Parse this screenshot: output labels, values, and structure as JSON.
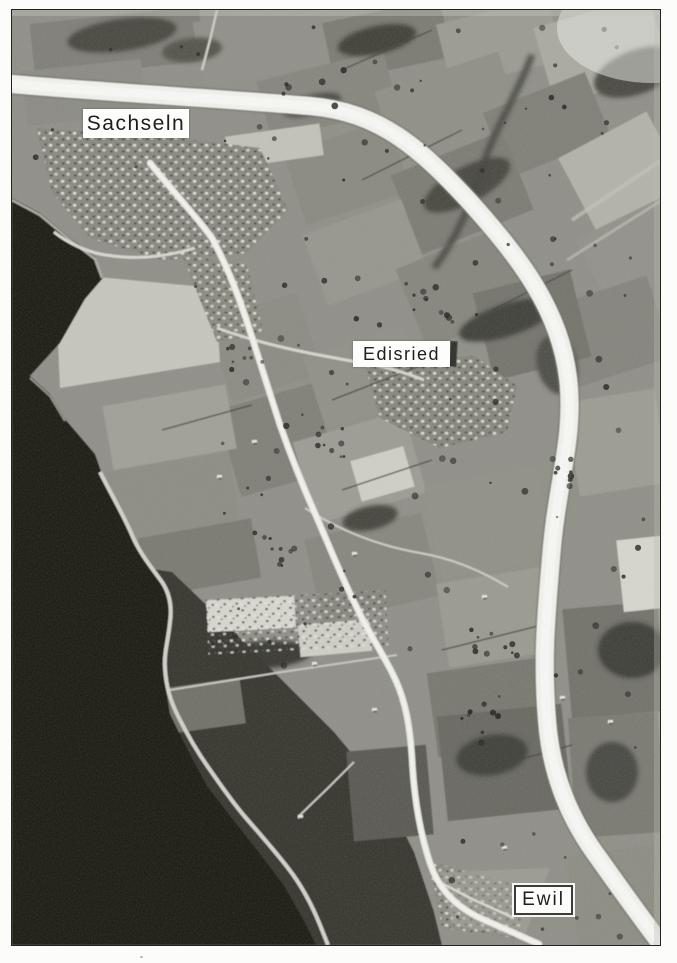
{
  "labels": {
    "sachseln": "Sachseln",
    "edisried": "Edisried",
    "ewil": "Ewil"
  },
  "palette": {
    "page_background": "#fcfcfa",
    "photo_base_gray": "#8e8e87",
    "lake_water": "#121210",
    "dark_shore_land": "#30302b",
    "highway_white": "#f3f3ef",
    "local_road": "#ebebe4",
    "label_background": "#fdfdfb",
    "label_text": "#1e1e1e",
    "ewil_label_border": "#3c3c3c"
  }
}
